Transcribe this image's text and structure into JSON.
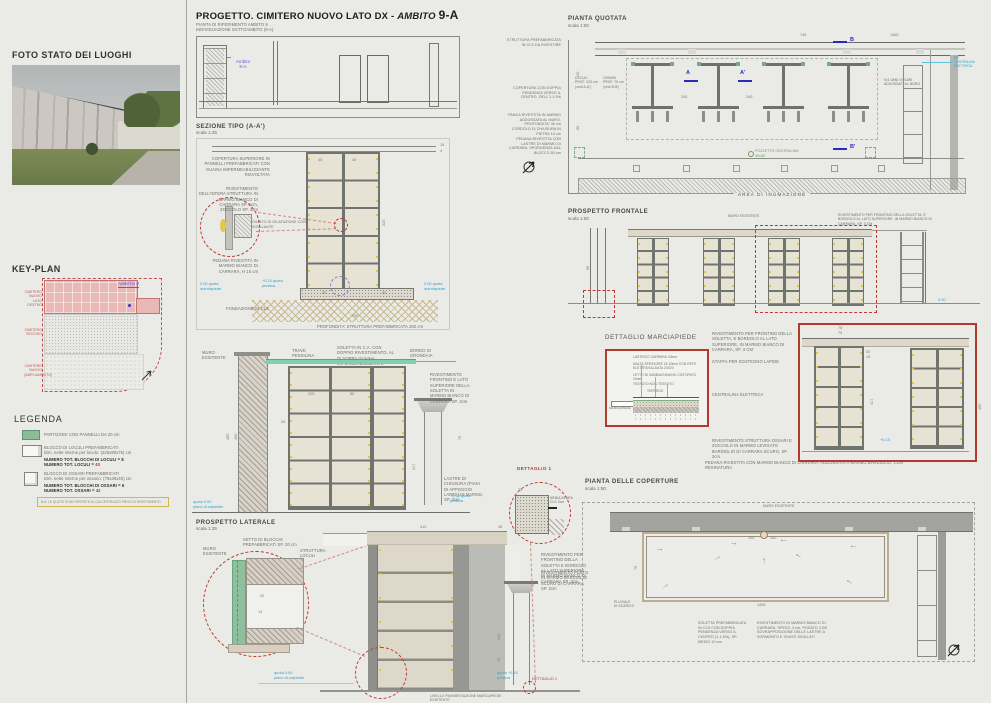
{
  "title": {
    "prefix": "PROGETTO. CIMITERO NUOVO LATO DX - ",
    "ambito_word": "AMBITO ",
    "code": "9-A"
  },
  "sidebar": {
    "photo_heading": "FOTO STATO DEI LUOGHI",
    "keyplan_heading": "KEY-PLAN",
    "keyplan": {
      "ambito_label": "AMBITO 9",
      "area1": "CIMITERO NUOVO\nLATO DESTRO",
      "area2": "CIMITERO\nVECCHIO",
      "area3": "CIMITERO NUOVO\n(AMPLIAMENTO)"
    },
    "legend_heading": "LEGENDA",
    "legend": {
      "item1": "PARTIZIONI CON PANNELLI DA 20 cm",
      "item2_title": "BLOCCO DI LOCULI PREFABBRICATI",
      "item2_sub": "Dim. nette interne per loculo: (225x80x75) cm",
      "item2_tot1": "NUMERO TOT. BLOCCHI DI LOCULI = 8",
      "item2_tot2": "NUMERO TOT. LOCULI = ",
      "item2_tot2_val": "40",
      "item3_title": "BLOCCO DI OSSARI PREFABBRICATI",
      "item3_sub": "Dim. nette interne per ossario: (75x30x45) cm",
      "item3_tot1": "NUMERO TOT. BLOCCHI DI OSSARI = 6",
      "item3_tot2": "NUMERO TOT. OSSARI = ",
      "item3_tot2_val": "42",
      "note": "N.B. LE QUOTE SONO RIFERITE AL CALCESTRUZZO PRIVO DI RIVESTIMENTO"
    }
  },
  "riferimento": {
    "title": "PIANTA DI RIFERIMENTO AMBITO 9",
    "subtitle": "INDIVIDUAZIONE SOTTOAMBITO (9-A)",
    "ambito_label": "Ambito\n9-A"
  },
  "sezione": {
    "title": "SEZIONE TIPO (A-A')",
    "scale": "scala 1:25",
    "ann_roof": "COPERTURA SUPERIORE IN PANNELLI PREFABBRICATI CON GUAINA IMPERMEABILIZZANTE RISVOLTATA",
    "ann_riv": "RIVESTIMENTO DELL'INTERA STRUTTURA IN MARMO BIANCO DI CARRARA SP. 2cm, ZOCCOLO SP. 3cm",
    "ann_giunto": "GIUNTO DI DILATAZIONE CON SIGILLANTE",
    "ann_pedana": "PEDANA RIVESTITA IN MARMO BIANCO DI CARRARA, H 15 cm",
    "ann_fond": "FONDAZIONE IN CLS",
    "ann_prof": "PROFONDITA' STRUTTURA PREFABBRICATA 250 cm",
    "d45a": "45",
    "d45b": "45",
    "d225": "225",
    "d60a": "60",
    "d60b": "60",
    "d250": "250",
    "d15": "15",
    "d4": "4",
    "q_ped": "+0.15 quota\npedana",
    "q_mar": "0.00 quota\nmarciapiede",
    "q_mar2": "0.00 quota\nmarciapiede"
  },
  "sezioneB": {
    "ann_muro": "MURO ESISTENTE",
    "ann_trave": "TRAVE PENSILINA",
    "ann_soletta": "SOLETTA IN C.A. CON DOPPIO RIVESTIMENTO, AL DI SOPRA GUAINA IMPERMEABILIZZANTE INTERPOSTA",
    "ann_bordo": "BORDO DI GRONDAIA",
    "ann_riv": "RIVESTIMENTO FRONTINO E LATO SUPERIORE DELLA SOLETTA IN MARMO BIANCO DI CARRARA SP. 3cm",
    "ann_lastre": "LASTRE DI CHIUSURA (PIANI DI APPOGGIO LAPIDI) IN MARMO, SP. 3cm",
    "d450": "450",
    "d400": "400",
    "d417": "417",
    "d75": "75",
    "d225": "225",
    "d80": "80",
    "d20": "20",
    "q_cal": "quota 0.00\npiano di calpestio",
    "q_ped": "+0.15 quota\npedana"
  },
  "laterale": {
    "title": "PROSPETTO LATERALE",
    "scale": "scala 1:25",
    "ann_setto": "SETTO DI BLOCCHI PREFABBRICATI SP. 20 cm",
    "ann_muro": "MURO ESISTENTE",
    "ann_struttura": "STRUTTURA LOCULI",
    "d20": "20",
    "d14": "14",
    "d410": "410",
    "d45": "45",
    "d75": "75",
    "ann_riv1": "RIVESTIMENTO PER FRONTINO DELLA SOLETTA E BORDOLO AL LATO SUPERIORE IN MARMO BIANCO DI CARRARA SP. 3cm",
    "ann_riv2": "RIVESTIMENTO FUSTO IN MARMO BARDIGLIO SCURO DI CARRARA SP. 2cm",
    "q_cal": "quota 0.00\npiano di calpestio",
    "q_ped": "quota +0.15\npedana",
    "det_label": "DETTAGLIO 1",
    "caption": "LIVELLO PAVIMENTAZIONE MARCIAPIEDE ESISTENTE"
  },
  "dettaglio1": {
    "title": "DETTAGLIO 1",
    "label": "NEBULATURA\nCLS 2cm",
    "d75": "75"
  },
  "quotata": {
    "title": "PIANTA QUOTATA",
    "scale": "scala 1:50",
    "ann1": "STRUTTURA PREFABBRICATA IN CLS DA RIVESTIRE",
    "ann2": "COPERTURA CON DOPPIA PENDENZA VERSO IL CENTRO, DELL'1-1.5%",
    "ann3": "PANCA RIVESTITA IN MARMO ADDOSSATA AL MURO, PROFONDITA' 45 cm",
    "ann4": "CORDOLO DI CHIUSURA IN PIETRA 10 cm",
    "ann5": "PEDANA RIVESTITA CON LASTRE DI MARMO DI CARRARA, SPORGENZA DAL BLOCCO 50 cm",
    "lbl_loculi": "LOCULI\nPROF. 225 cm\n(vedi A-A')",
    "lbl_ossari": "OSSARI\nPROF. 75 cm\n(vedi B-B')",
    "lbl_nicchia": "N.6 VANI OSSARI ADDOSSATI AL MURO",
    "lbl_pozzetto": "POZZETTO CENTRALINA\n30x30",
    "lbl_area": "AREA DI INUMAZIONE",
    "lbl_rif": "RIF.\nCENTRALINA\nELETTRICA",
    "mA": "A",
    "mA2": "A'",
    "mB": "B",
    "mB2": "B'",
    "d745": "745",
    "d1465": "1465",
    "d240a": "240",
    "d240b": "240",
    "d120": "120",
    "d90": "90"
  },
  "frontale": {
    "title": "PROSPETTO FRONTALE",
    "scale": "scala 1:50",
    "ann_muro": "MURO ESISTENTE",
    "ann_riv": "RIVESTIMENTO PER FRONTINO DELLA SOLETTA, E BORDOLO AL LATO SUPERIORE, IN MARMO BIANCO DI CARRARA, SP. 3 CM",
    "d90": "90",
    "q0": "0.00"
  },
  "marciapiede": {
    "title": "DETTAGLIO MARCIAPIEDE",
    "l1": "LASTRICO CARRARA 20mm",
    "l2": "MALTA SPESSORE 15-20mm CON RETE ELETTROSALDATA 20X20",
    "l3": "LETTO DI SABBIA/GHIAINO COSTIPATO 20mm",
    "l4": "TESSUTO NON TESSUTO",
    "l5": "TERRENO",
    "lbl_marciapiede": "MARCIAPIEDE",
    "ann1": "RIVESTIMENTO PER FRONTINO DELLA SOLETTA, E BORDOLO AL LATO SUPERIORE, IN MARMO BIANCO DI CARRARA, SP. 3 CM",
    "ann2": "STAFFA PER SOSTEGNO LAPIDE",
    "ann3": "CENTRALINA ELETTRICA",
    "ann4": "RIVESTIMENTO STRUTTURA OSSARI E ZOCCOLO IN MARMO LEVIGATO BARDIGLIO DI CARRARA SCURO, SP. 2cm",
    "ann5": "PEDANA RIVESTITA CON MARMO BIANCO DI CARRARA, ADDOSSATA A MARMO BARDIGLIO, CON RESINATURA"
  },
  "ossari": {
    "d78": "78",
    "d75": "75",
    "d417": "417",
    "d52": "52",
    "d15": "15",
    "d450": "450",
    "q015": "+0.15"
  },
  "coperture": {
    "title": "PIANTA DELLE COPERTURE",
    "scale": "scala 1:50",
    "lbl_muro": "MURO ESISTENTE",
    "d100a": "100",
    "d100b": "100",
    "d1495": "1495",
    "d75": "75",
    "lbl_pluviale": "PLUVIALE\nDI SCARICO",
    "ann1": "SOLETTA PREFABBRICATA IN CLS CON DOPPIA PENDENZA VERSO IL CENTRO (1-1.5%), SP. MEDIO 10 cm",
    "ann2": "RIVESTIMENTO IN MARMO BIANCO DI CARRARA, SPESS. 3 cm, POSATO CON SOVRAPPOSIZIONE DELLE LASTRE A SORMONTO E GIUNTI SIGILLATI"
  }
}
